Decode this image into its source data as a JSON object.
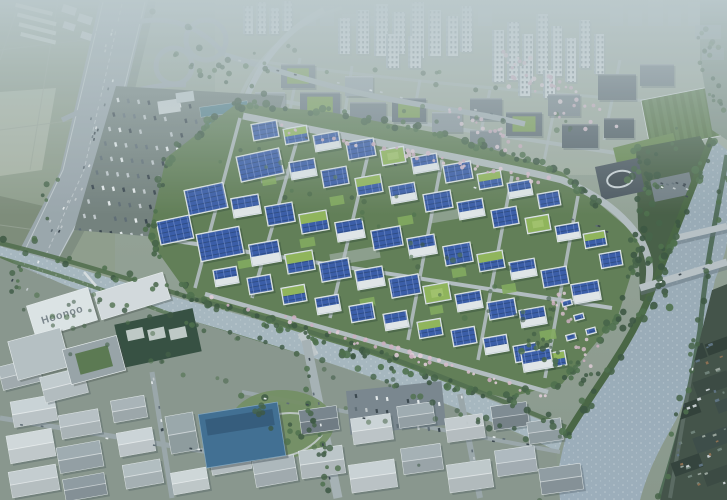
{
  "scene": {
    "scene_type": "aerial-architectural-rendering",
    "roof_label": "Hoonoo",
    "palette": {
      "solar_panel_blue": "#3256a6",
      "solar_panel_dark": "#24437f",
      "green_roof": "#8fb554",
      "campus_green": "#5d7a50",
      "river_water": "#93a5b2",
      "stream_water": "#a7b7bf",
      "haze": "#bdcbce",
      "road_gray": "#9aa5ab",
      "building_white": "#e4e9eb",
      "tree_green": "#3f5d40",
      "blossom_pink": "#d8bccb",
      "field_green": "#8e9c89",
      "steel_blue_roof": "#3a6a90",
      "dark_industrial": "#3c4b41"
    },
    "campus": {
      "outline": [
        [
          236,
          104
        ],
        [
          330,
          112
        ],
        [
          452,
          136
        ],
        [
          562,
          172
        ],
        [
          642,
          240
        ],
        [
          618,
          316
        ],
        [
          562,
          384
        ],
        [
          506,
          398
        ],
        [
          398,
          372
        ],
        [
          300,
          334
        ],
        [
          188,
          294
        ],
        [
          148,
          238
        ],
        [
          166,
          158
        ]
      ],
      "buildings": [
        [
          252,
          122,
          26,
          17,
          -10,
          "pv"
        ],
        [
          284,
          127,
          24,
          16,
          -10,
          "gpv"
        ],
        [
          314,
          133,
          26,
          17,
          -10,
          "wpv"
        ],
        [
          347,
          140,
          28,
          18,
          -10,
          "pv"
        ],
        [
          381,
          148,
          24,
          16,
          -10,
          "green"
        ],
        [
          412,
          155,
          26,
          17,
          -10,
          "wpv"
        ],
        [
          444,
          163,
          28,
          18,
          -10,
          "pv"
        ],
        [
          478,
          172,
          24,
          16,
          -10,
          "gpv"
        ],
        [
          508,
          181,
          24,
          16,
          -10,
          "wpv"
        ],
        [
          538,
          192,
          22,
          15,
          -10,
          "pv"
        ],
        [
          238,
          152,
          44,
          26,
          -12,
          "pv"
        ],
        [
          290,
          160,
          26,
          18,
          -10,
          "wpv"
        ],
        [
          322,
          168,
          26,
          18,
          -10,
          "pv"
        ],
        [
          356,
          176,
          26,
          18,
          -10,
          "gpv"
        ],
        [
          390,
          184,
          26,
          18,
          -10,
          "wpv"
        ],
        [
          424,
          192,
          28,
          18,
          -10,
          "pv"
        ],
        [
          458,
          200,
          26,
          18,
          -10,
          "wpv"
        ],
        [
          492,
          208,
          26,
          18,
          -10,
          "pv"
        ],
        [
          526,
          216,
          24,
          16,
          -10,
          "green"
        ],
        [
          556,
          224,
          24,
          16,
          -10,
          "wpv"
        ],
        [
          584,
          232,
          22,
          15,
          -10,
          "gpv"
        ],
        [
          600,
          252,
          22,
          15,
          -10,
          "pv"
        ],
        [
          186,
          186,
          40,
          26,
          -12,
          "pv"
        ],
        [
          232,
          196,
          28,
          20,
          -10,
          "wpv"
        ],
        [
          266,
          204,
          28,
          20,
          -10,
          "pv"
        ],
        [
          300,
          212,
          28,
          20,
          -10,
          "gpv"
        ],
        [
          336,
          220,
          28,
          20,
          -10,
          "wpv"
        ],
        [
          372,
          228,
          30,
          20,
          -10,
          "pv"
        ],
        [
          408,
          236,
          28,
          20,
          -10,
          "wpv"
        ],
        [
          444,
          244,
          28,
          20,
          -10,
          "pv"
        ],
        [
          478,
          252,
          26,
          18,
          -10,
          "gpv"
        ],
        [
          510,
          260,
          26,
          18,
          -10,
          "wpv"
        ],
        [
          542,
          268,
          26,
          18,
          -10,
          "pv"
        ],
        [
          572,
          282,
          28,
          20,
          -10,
          "wpv"
        ],
        [
          158,
          218,
          34,
          24,
          -12,
          "pv"
        ],
        [
          198,
          230,
          44,
          28,
          -11,
          "pv"
        ],
        [
          250,
          242,
          30,
          22,
          -10,
          "wpv"
        ],
        [
          286,
          252,
          28,
          20,
          -10,
          "gpv"
        ],
        [
          320,
          260,
          30,
          20,
          -10,
          "pv"
        ],
        [
          356,
          268,
          28,
          20,
          -10,
          "wpv"
        ],
        [
          390,
          276,
          30,
          20,
          -10,
          "pv"
        ],
        [
          424,
          284,
          26,
          18,
          -10,
          "green"
        ],
        [
          456,
          292,
          26,
          18,
          -10,
          "wpv"
        ],
        [
          488,
          300,
          28,
          18,
          -10,
          "pv"
        ],
        [
          520,
          308,
          26,
          18,
          -10,
          "wpv"
        ],
        [
          214,
          268,
          24,
          17,
          -10,
          "wpv"
        ],
        [
          248,
          276,
          24,
          17,
          -10,
          "pv"
        ],
        [
          282,
          286,
          24,
          17,
          -10,
          "gpv"
        ],
        [
          316,
          296,
          24,
          17,
          -10,
          "wpv"
        ],
        [
          350,
          304,
          24,
          17,
          -10,
          "pv"
        ],
        [
          384,
          312,
          24,
          17,
          -10,
          "wpv"
        ],
        [
          418,
          320,
          24,
          17,
          -10,
          "gpv"
        ],
        [
          452,
          328,
          24,
          17,
          -10,
          "pv"
        ],
        [
          484,
          336,
          24,
          17,
          -10,
          "wpv"
        ],
        [
          514,
          344,
          24,
          17,
          -10,
          "pv"
        ],
        [
          544,
          352,
          22,
          15,
          -10,
          "gpv"
        ],
        [
          562,
          300,
          10,
          6,
          -15,
          "pv"
        ],
        [
          574,
          314,
          10,
          6,
          -15,
          "pv"
        ],
        [
          586,
          328,
          10,
          6,
          -15,
          "pv"
        ],
        [
          566,
          334,
          10,
          6,
          -15,
          "pv"
        ],
        [
          522,
          350,
          30,
          20,
          -10,
          "wpv"
        ]
      ],
      "lawns": [
        [
          262,
          176,
          14,
          9
        ],
        [
          330,
          196,
          14,
          9
        ],
        [
          398,
          216,
          15,
          9
        ],
        [
          300,
          238,
          15,
          9
        ],
        [
          452,
          268,
          14,
          9
        ],
        [
          502,
          284,
          14,
          9
        ],
        [
          360,
          298,
          15,
          9
        ],
        [
          238,
          260,
          13,
          8
        ],
        [
          430,
          306,
          13,
          8
        ],
        [
          540,
          330,
          16,
          10
        ]
      ],
      "plazas": [
        [
          260,
          170,
          40,
          10
        ],
        [
          330,
          250,
          50,
          12
        ],
        [
          430,
          210,
          40,
          10
        ]
      ]
    },
    "city": {
      "skyline": [
        [
          300,
          16,
          14
        ],
        [
          320,
          14,
          20
        ],
        [
          342,
          15,
          12
        ],
        [
          363,
          12,
          10
        ],
        [
          450,
          12,
          12
        ],
        [
          478,
          14,
          18
        ],
        [
          610,
          13,
          22
        ],
        [
          628,
          14,
          16
        ],
        [
          648,
          15,
          26
        ],
        [
          668,
          13,
          18
        ],
        [
          688,
          14,
          24
        ],
        [
          706,
          13,
          16
        ]
      ],
      "towers": [
        [
          356,
          10,
          13,
          44
        ],
        [
          374,
          4,
          14,
          52
        ],
        [
          392,
          12,
          13,
          42
        ],
        [
          410,
          2,
          14,
          56
        ],
        [
          428,
          10,
          13,
          46
        ],
        [
          446,
          16,
          12,
          40
        ],
        [
          460,
          6,
          12,
          46
        ],
        [
          386,
          34,
          13,
          34
        ],
        [
          408,
          36,
          13,
          32
        ],
        [
          338,
          18,
          12,
          36
        ],
        [
          492,
          30,
          12,
          52
        ],
        [
          507,
          22,
          12,
          58
        ],
        [
          522,
          34,
          11,
          48
        ],
        [
          536,
          14,
          12,
          60
        ],
        [
          551,
          26,
          11,
          50
        ],
        [
          565,
          38,
          11,
          44
        ],
        [
          579,
          20,
          11,
          48
        ],
        [
          518,
          66,
          12,
          30
        ],
        [
          543,
          70,
          12,
          28
        ],
        [
          594,
          34,
          10,
          40
        ],
        [
          243,
          6,
          10,
          28
        ],
        [
          256,
          2,
          10,
          32
        ],
        [
          269,
          8,
          10,
          26
        ],
        [
          282,
          1,
          10,
          30
        ]
      ],
      "blocks": [
        [
          281,
          64,
          34,
          24,
          "#6f7b81",
          1
        ],
        [
          255,
          92,
          30,
          20,
          "#8d979c",
          0
        ],
        [
          300,
          92,
          40,
          26,
          "#66727a",
          1
        ],
        [
          345,
          76,
          28,
          20,
          "#97a2a7",
          0
        ],
        [
          350,
          102,
          36,
          24,
          "#717d84",
          0
        ],
        [
          392,
          98,
          34,
          24,
          "#5e6a72",
          1
        ],
        [
          432,
          112,
          30,
          20,
          "#89949a",
          0
        ],
        [
          470,
          98,
          32,
          22,
          "#6c777e",
          0
        ],
        [
          506,
          112,
          36,
          24,
          "#5c6870",
          1
        ],
        [
          548,
          94,
          32,
          22,
          "#768189",
          0
        ],
        [
          562,
          124,
          36,
          24,
          "#515d65",
          0
        ],
        [
          598,
          74,
          38,
          26,
          "#59646c",
          0
        ],
        [
          640,
          64,
          34,
          22,
          "#6b767d",
          0
        ],
        [
          604,
          118,
          30,
          20,
          "#4b575e",
          0
        ],
        [
          470,
          130,
          30,
          20,
          "#7b868d",
          0
        ],
        [
          430,
          140,
          34,
          20,
          "#8b969b",
          1
        ]
      ]
    },
    "industrial": {
      "buildings": [
        [
          12,
          398,
          44,
          26,
          -10,
          "#cdd5d8"
        ],
        [
          60,
          412,
          40,
          24,
          -10,
          "#b9c2c6"
        ],
        [
          8,
          432,
          46,
          28,
          -10,
          "#d4dbdd"
        ],
        [
          58,
          444,
          44,
          26,
          -10,
          "#9fabb0"
        ],
        [
          10,
          468,
          48,
          26,
          -10,
          "#c7cfd2"
        ],
        [
          64,
          476,
          42,
          22,
          -10,
          "#8e9aa0"
        ],
        [
          112,
          398,
          34,
          22,
          -10,
          "#aab4b8"
        ],
        [
          118,
          430,
          36,
          24,
          -10,
          "#cfd6d9"
        ],
        [
          124,
          462,
          38,
          24,
          -10,
          "#b4bec2"
        ],
        [
          168,
          414,
          28,
          38,
          -10,
          "#9aa6aa"
        ],
        [
          210,
          446,
          40,
          26,
          -10,
          "#c6ced1"
        ],
        [
          254,
          458,
          42,
          26,
          -10,
          "#aeb8bc"
        ],
        [
          172,
          470,
          36,
          22,
          -10,
          "#d2d9db"
        ],
        [
          300,
          448,
          44,
          28,
          -8,
          "#bec7ca"
        ],
        [
          350,
          462,
          46,
          28,
          -8,
          "#cdd4d7"
        ],
        [
          402,
          446,
          40,
          26,
          -8,
          "#a5b0b5"
        ],
        [
          448,
          462,
          44,
          28,
          -8,
          "#c2cacd"
        ],
        [
          496,
          448,
          40,
          26,
          -8,
          "#b0bac0"
        ],
        [
          540,
          466,
          42,
          26,
          -8,
          "#8f9ba1"
        ],
        [
          300,
          408,
          38,
          24,
          -8,
          "#76828a"
        ],
        [
          352,
          416,
          40,
          26,
          -8,
          "#cfd6d9"
        ],
        [
          398,
          404,
          36,
          22,
          -8,
          "#9fabb0"
        ],
        [
          446,
          416,
          38,
          24,
          -8,
          "#c6cdd0"
        ],
        [
          492,
          404,
          36,
          24,
          -8,
          "#7c8890"
        ],
        [
          242,
          416,
          34,
          22,
          -8,
          "#bac3c7"
        ],
        [
          0,
          362,
          40,
          24,
          -14,
          "#aeb8bc"
        ],
        [
          42,
          372,
          44,
          26,
          -14,
          "#c4ccd0"
        ],
        [
          528,
          420,
          34,
          22,
          -8,
          "#9aa5ab"
        ]
      ],
      "steel_blue_building": [
        202,
        408,
        80,
        54,
        -9
      ],
      "teal_sheds": [
        [
          200,
          104,
          48,
          10,
          -8
        ],
        [
          206,
          117,
          52,
          11,
          -8
        ],
        [
          214,
          131,
          48,
          10,
          -8
        ]
      ],
      "dark_east_buildings": [
        [
          672,
          348,
          34,
          15,
          -20
        ],
        [
          694,
          376,
          36,
          16,
          -20
        ],
        [
          668,
          404,
          32,
          14,
          -20
        ],
        [
          694,
          432,
          36,
          16,
          -20
        ],
        [
          672,
          458,
          30,
          14,
          -20
        ],
        [
          704,
          468,
          30,
          14,
          -20
        ],
        [
          706,
          340,
          24,
          12,
          -20
        ],
        [
          716,
          398,
          24,
          12,
          -20
        ]
      ]
    },
    "hoonoo_complex": {
      "roofs": [
        [
          30,
          296,
          64,
          34,
          -17,
          "#e0e6e8",
          0
        ],
        [
          96,
          282,
          72,
          28,
          -17,
          "#d6dcdf",
          0
        ],
        [
          12,
          334,
          54,
          40,
          -15,
          "#b7c0c4",
          0
        ],
        [
          66,
          342,
          56,
          36,
          -15,
          "#97a2a7",
          1
        ]
      ]
    }
  }
}
